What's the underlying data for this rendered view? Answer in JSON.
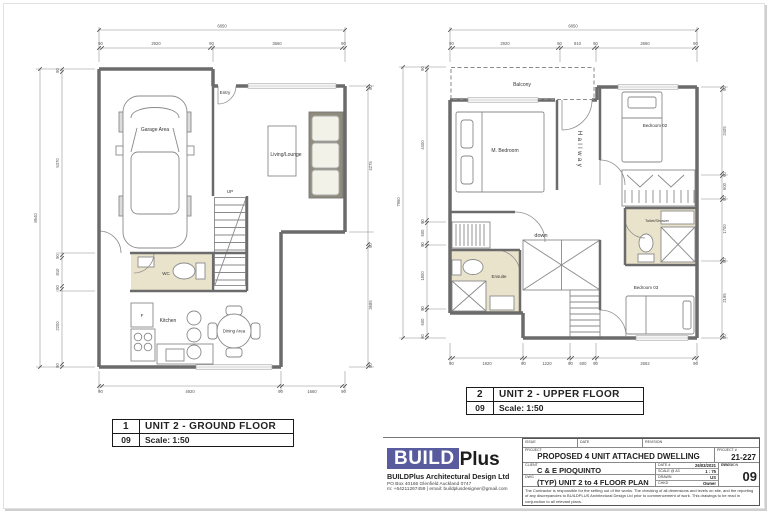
{
  "ground": {
    "header": {
      "num": "1",
      "title": "UNIT 2 - GROUND FLOOR",
      "sheet": "09",
      "scale": "Scale: 1:50"
    },
    "rooms": {
      "entry": "Entry",
      "garage": "Garage Area",
      "living": "Living/Lounge",
      "up": "UP",
      "wc": "WC",
      "kitchen": "Kitchen",
      "fridge": "F",
      "dining": "Dining Area"
    },
    "dims": {
      "top_total": "6850",
      "top": [
        "90",
        "2920",
        "90",
        "3660",
        "90"
      ],
      "left_total": "8640",
      "left": [
        "90",
        "5370",
        "90",
        "810",
        "90",
        "2200",
        "90"
      ],
      "right": [
        "90",
        "4275",
        "90",
        "3685",
        "90"
      ],
      "bottom": [
        "90",
        "4920",
        "90",
        "1660",
        "90"
      ]
    }
  },
  "upper": {
    "header": {
      "num": "2",
      "title": "UNIT 2 - UPPER FLOOR",
      "sheet": "09",
      "scale": "Scale: 1:50"
    },
    "rooms": {
      "balcony": "Balcony",
      "m_bedroom": "M. Bedroom",
      "bedroom02": "Bedroom 02",
      "hallway": "Hallway",
      "toilet_shower": "Toilet/Shower",
      "down": "down",
      "ensuite": "Ensuite",
      "bedroom03": "Bedroom 03"
    },
    "dims": {
      "top_total": "6850",
      "top": [
        "90",
        "2920",
        "90",
        "910",
        "90",
        "2660",
        "90"
      ],
      "left_total": "7960",
      "left": [
        "90",
        "4400",
        "90",
        "600",
        "90",
        "1800",
        "90",
        "600",
        "90"
      ],
      "right": [
        "90",
        "2405",
        "90",
        "600",
        "90",
        "1700",
        "90",
        "2195",
        "90"
      ],
      "bottom": [
        "90",
        "1920",
        "90",
        "1220",
        "90",
        "600",
        "90",
        "2662",
        "90"
      ]
    }
  },
  "title_block": {
    "logo_build": "BUILD",
    "logo_plus": "Plus",
    "company": "BUILDPlus Architectural Design Ltd",
    "address": "PO Box 40166 Glenfield Auckland 0747",
    "contact": "m: +64211267459  |  email: buildplusdesigner@gmail.com",
    "labels": {
      "issue": "ISSUE",
      "date": "DATE",
      "revision": "REVISION",
      "project": "PROJECT",
      "client": "CLIENT",
      "dwg": "DWG",
      "project_no": "PROJECT #",
      "dwg_no": "DWG #",
      "date_no": "DATE #",
      "scale_a3": "SCALE @ A3",
      "drawn": "DRAWN",
      "chkd": "CHKD",
      "revision2": "REVISION"
    },
    "project": "PROPOSED 4 UNIT ATTACHED DWELLING",
    "project_no": "21-227",
    "client": "C & E PIOQUINTO",
    "date_value": "26/03/2021",
    "scale_value": "1 : 75",
    "drawn_value": "US",
    "chkd_value": "Owner",
    "dwg_title": "(TYP) UNIT 2 to 4 FLOOR PLAN",
    "dwg_no_value": "09",
    "disclaimer": "The Contractor is responsible for the setting out of the works. The checking of all dimensions and levels on site, and the reporting of any discrepancies to BUILDPLUS Architectural Design Ltd prior to commencement of work. This drawings to be read in conjunction to all relevant plans."
  },
  "colors": {
    "wall": "#6b6b6b",
    "bath_floor": "#eae3cb",
    "sofa": "#8f8c7c",
    "logo_blue": "#585c9e"
  }
}
